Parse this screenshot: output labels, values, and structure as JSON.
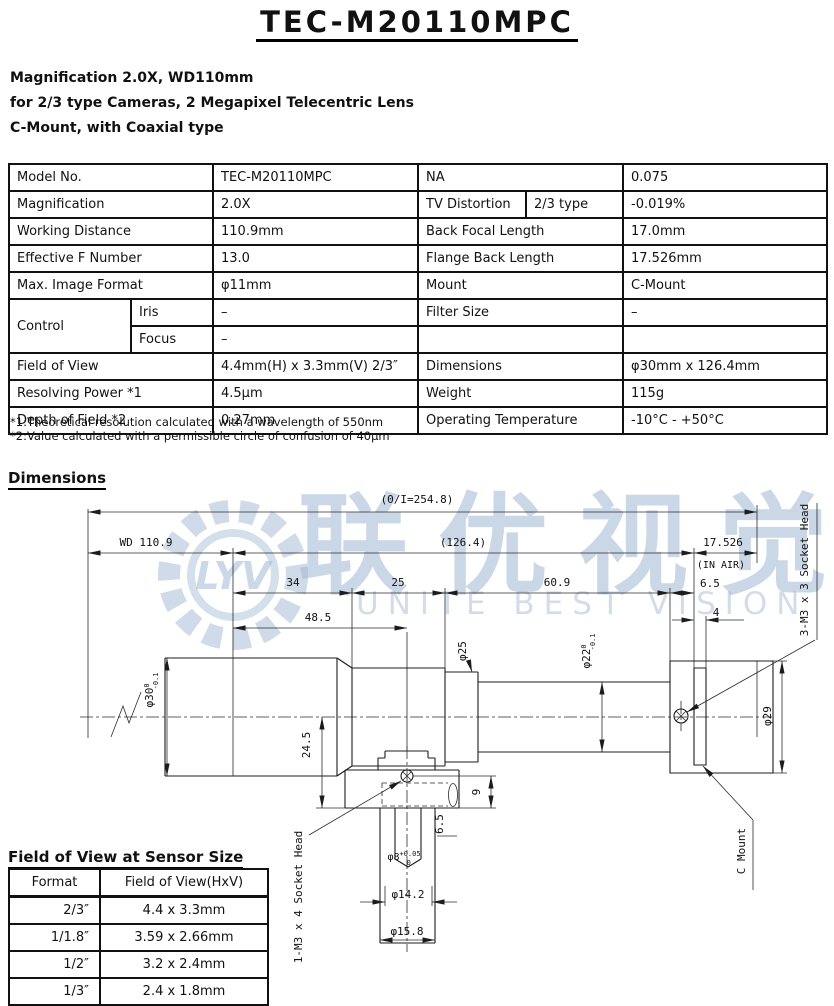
{
  "header": {
    "title": "TEC-M20110MPC",
    "subtitle_lines": [
      "Magnification 2.0X, WD110mm",
      "for 2/3 type Cameras, 2 Megapixel Telecentric Lens",
      "C-Mount, with Coaxial type"
    ]
  },
  "spec_table": {
    "rows": [
      {
        "l_label": "Model No.",
        "l_value": "TEC-M20110MPC",
        "r_label": "NA",
        "r_value": "0.075"
      },
      {
        "l_label": "Magnification",
        "l_value": "2.0X",
        "r_label": "TV Distortion",
        "r_sub": "2/3 type",
        "r_value": "-0.019%"
      },
      {
        "l_label": "Working Distance",
        "l_value": "110.9mm",
        "r_label": "Back Focal Length",
        "r_value": "17.0mm"
      },
      {
        "l_label": "Effective F Number",
        "l_value": "13.0",
        "r_label": "Flange Back Length",
        "r_value": "17.526mm"
      },
      {
        "l_label": "Max. Image Format",
        "l_value": "φ11mm",
        "r_label": "Mount",
        "r_value": "C-Mount"
      },
      {
        "l_label": "Control",
        "l_sub": "Iris",
        "l_value": "–",
        "r_label": "Filter Size",
        "r_value": "–"
      },
      {
        "l_sub": "Focus",
        "l_value": "–",
        "r_label": "",
        "r_value": ""
      },
      {
        "l_label": "Field of View",
        "l_value": "4.4mm(H) x 3.3mm(V) 2/3″",
        "r_label": "Dimensions",
        "r_value": "φ30mm x 126.4mm"
      },
      {
        "l_label": "Resolving Power *1",
        "l_value": "4.5μm",
        "r_label": "Weight",
        "r_value": "115g"
      },
      {
        "l_label": "Depth of Field *2",
        "l_value": "0.27mm",
        "r_label": "Operating Temperature",
        "r_value": "-10°C - +50°C"
      }
    ]
  },
  "notes": [
    "*1:Theoretical resolution calculated with a wavelength of 550nm",
    "*2:Value calculated with a permissible circle of confusion of 40μm"
  ],
  "dimensions": {
    "heading": "Dimensions",
    "labels": {
      "overall": "(0/I=254.8)",
      "wd": "WD 110.9",
      "mid": "(126.4)",
      "flange": "17.526",
      "in_air": "(IN AIR)",
      "seg34": "34",
      "seg25": "25",
      "seg609": "60.9",
      "seg65": "6.5",
      "seg4": "4",
      "seg485": "48.5",
      "dia30": "φ30",
      "dia30_tol_u": "0",
      "dia30_tol_l": "-0.1",
      "dia25": "φ25",
      "dia22": "φ22",
      "dia22_tol_u": "0",
      "dia22_tol_l": "-0.1",
      "dia29": "φ29",
      "dia8": "φ8",
      "dia8_tol_u": "+0.05",
      "dia8_tol_l": "0",
      "dia142": "φ14.2",
      "dia158": "φ15.8",
      "v245": "24.5",
      "v9": "9",
      "v65": "6.5",
      "socket3": "3-M3 x 3 Socket Head",
      "socket1": "1-M3 x 4 Socket Head",
      "cmount": "C Mount"
    }
  },
  "fov": {
    "heading": "Field of View at Sensor Size",
    "headers": [
      "Format",
      "Field of View(HxV)"
    ],
    "rows": [
      [
        "2/3″",
        "4.4 x 3.3mm"
      ],
      [
        "1/1.8″",
        "3.59 x 2.66mm"
      ],
      [
        "1/2″",
        "3.2 x 2.4mm"
      ],
      [
        "1/3″",
        "2.4 x 1.8mm"
      ]
    ]
  },
  "watermark": {
    "logo_text": "LYV",
    "cn": "联优视觉",
    "en": "UNITE BEST VISION"
  }
}
